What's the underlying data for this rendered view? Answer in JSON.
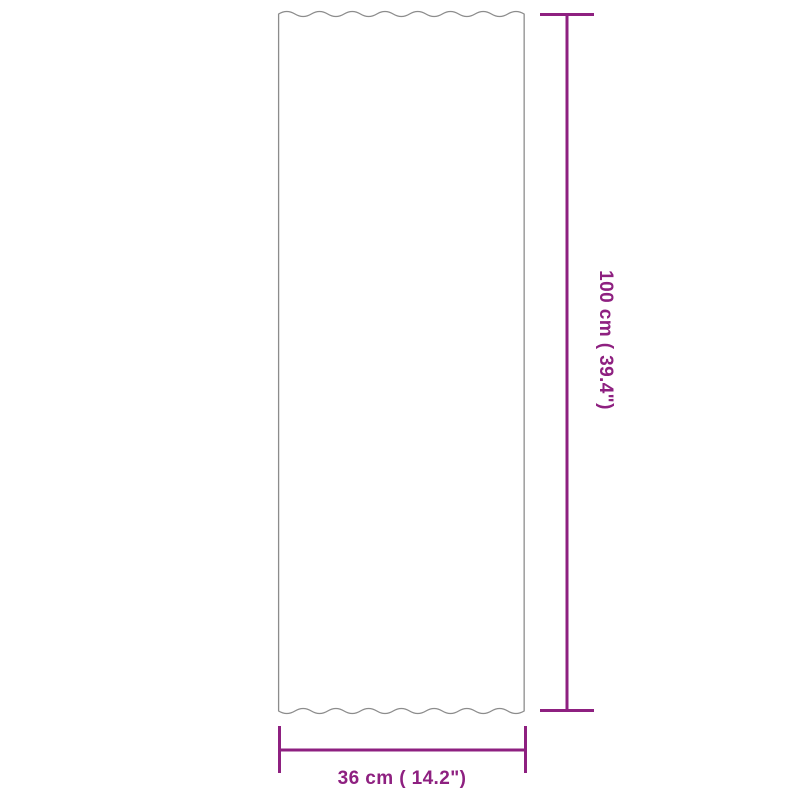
{
  "diagram": {
    "width_label": "36 cm ( 14.2\")",
    "height_label": "100 cm ( 39.4\")"
  },
  "colors": {
    "dimension_accent": "#8e2080",
    "panel_outline": "#8c8c8c",
    "background": "#ffffff"
  }
}
